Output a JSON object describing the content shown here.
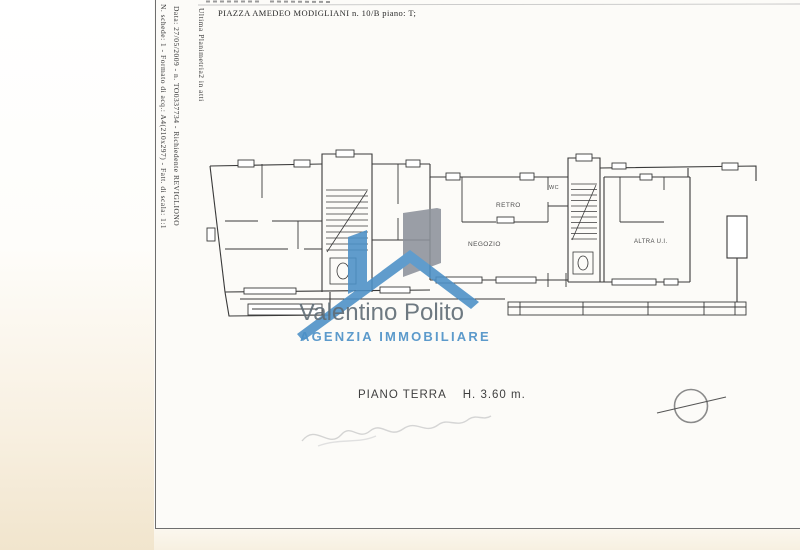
{
  "header": {
    "address_line": "PIAZZA AMEDEO MODIGLIANI n. 10/B piano: T;"
  },
  "margin_notes": {
    "line1": "Ultima Planimetria2 in atti",
    "line2": "Data: 27/05/2009 - n. TO0337734 - Richiedente REVIGLIONO",
    "line3": "N. schede: 1 - Formato di acq.: A4(210x297) - Fatt. di scala: 1:1"
  },
  "plan": {
    "room_labels": {
      "retro": "RETRO",
      "wc": "WC",
      "negozio": "NEGOZIO",
      "altra_ui": "ALTRA U.I."
    },
    "floor_symbols": [
      "staircase-left",
      "staircase-right",
      "north-orientation-circle"
    ]
  },
  "watermark": {
    "agency_name": "Valentino Polito",
    "agency_subtitle": "AGENZIA IMMOBILIARE",
    "brand_blue": "#4b90c7",
    "brand_gray": "#8d929b",
    "name_color": "#5f6c75"
  },
  "footer": {
    "floor_label": "PIANO TERRA",
    "height_label": "H. 3.60 m."
  }
}
